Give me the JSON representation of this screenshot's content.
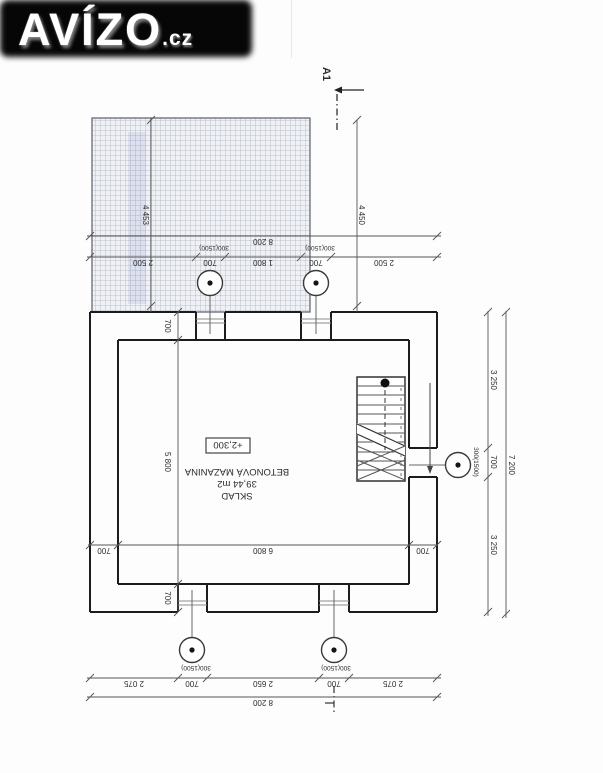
{
  "logo": {
    "text": "AVÍZO",
    "suffix": ".cz",
    "bg_color": "#060606",
    "text_color": "#ffffff"
  },
  "drawing": {
    "section_marker": {
      "label": "A1"
    },
    "room": {
      "name": "SKLAD",
      "area": "39,44 m2",
      "floor": "BETONOVÁ MAZANINA",
      "level": "+2,300"
    },
    "symbols": {
      "vent_circle": "circle-with-dot"
    },
    "dims": {
      "top_overall": "8 200",
      "top_chain": [
        "2 500",
        "700",
        "1 800",
        "700",
        "2 500"
      ],
      "window_label": "300(1500)",
      "hatch_height_left": "4 453",
      "hatch_height_right": "4 450",
      "right_overall": "7 200",
      "right_chain": [
        "3 250",
        "700",
        "3 250"
      ],
      "bottom_overall": "8 200",
      "bottom_chain": [
        "2 075",
        "700",
        "2 650",
        "700",
        "2 075"
      ],
      "inner_width": [
        "700",
        "6 800",
        "700"
      ],
      "inner_height": [
        "700",
        "5 800",
        "700"
      ]
    }
  }
}
